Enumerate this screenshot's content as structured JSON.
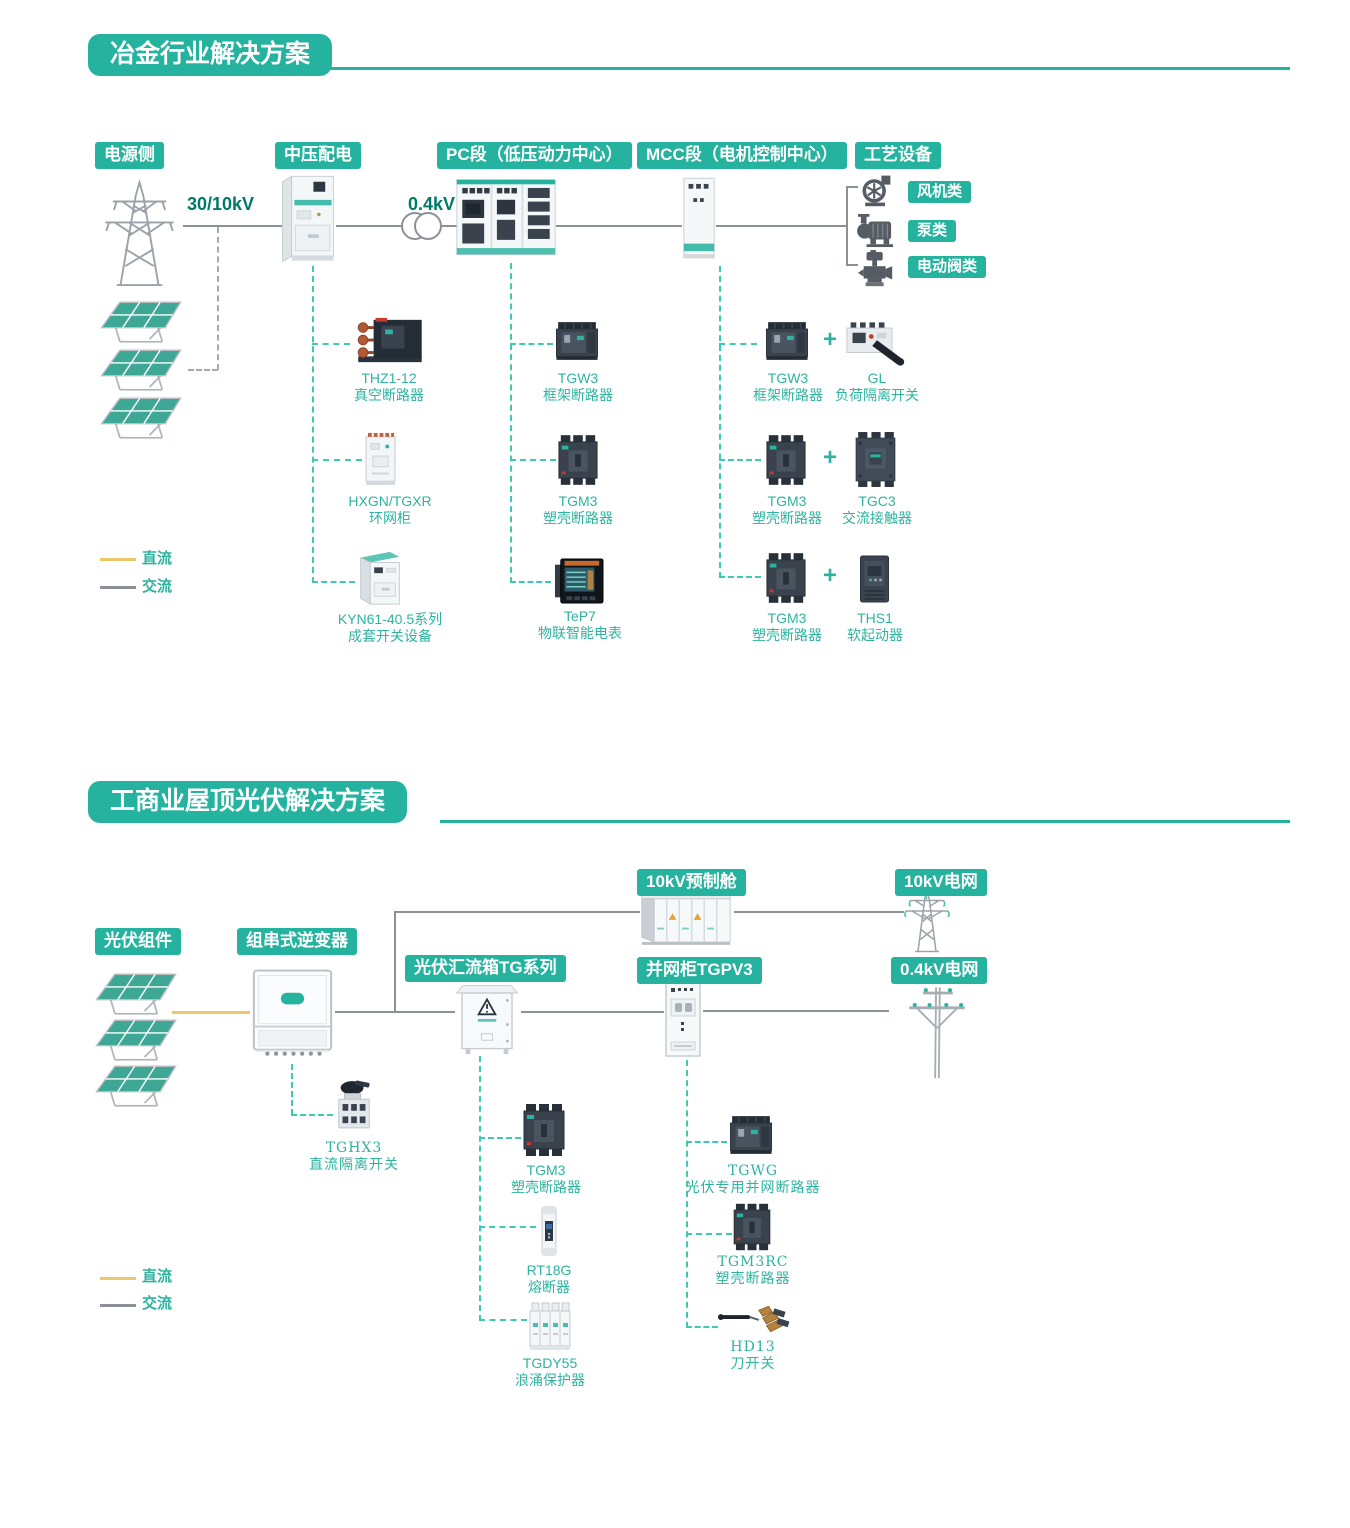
{
  "section1": {
    "title": "冶金行业解决方案",
    "stages": {
      "power": "电源侧",
      "mv": "中压配电",
      "pc": "PC段（低压动力中心）",
      "mcc": "MCC段（电机控制中心）",
      "process": "工艺设备"
    },
    "voltages": {
      "grid": "30/10kV",
      "lv": "0.4kV"
    },
    "equipment": {
      "fan": "风机类",
      "pump": "泵类",
      "valve": "电动阀类"
    },
    "mv_products": [
      {
        "model": "THZ1-12",
        "desc": "真空断路器"
      },
      {
        "model": "HXGN/TGXR",
        "desc": "环网柜"
      },
      {
        "model": "KYN61-40.5系列",
        "desc": "成套开关设备"
      }
    ],
    "pc_products": [
      {
        "model": "TGW3",
        "desc": "框架断路器"
      },
      {
        "model": "TGM3",
        "desc": "塑壳断路器"
      },
      {
        "model": "TeP7",
        "desc": "物联智能电表"
      }
    ],
    "mcc_pairs": [
      {
        "left": {
          "model": "TGW3",
          "desc": "框架断路器"
        },
        "plus": "+",
        "right": {
          "model": "GL",
          "desc": "负荷隔离开关"
        }
      },
      {
        "left": {
          "model": "TGM3",
          "desc": "塑壳断路器"
        },
        "plus": "+",
        "right": {
          "model": "TGC3",
          "desc": "交流接触器"
        }
      },
      {
        "left": {
          "model": "TGM3",
          "desc": "塑壳断路器"
        },
        "plus": "+",
        "right": {
          "model": "THS1",
          "desc": "软起动器"
        }
      }
    ],
    "legend": {
      "dc": "直流",
      "ac": "交流"
    }
  },
  "section2": {
    "title": "工商业屋顶光伏解决方案",
    "stages": {
      "pv": "光伏组件",
      "inverter": "组串式逆变器",
      "combiner": "光伏汇流箱TG系列",
      "grid_cabinet": "并网柜TGPV3",
      "cabin": "10kV预制舱",
      "grid10": "10kV电网",
      "grid04": "0.4kV电网"
    },
    "inverter_products": [
      {
        "model": "TGHX3",
        "desc": "直流隔离开关"
      }
    ],
    "combiner_products": [
      {
        "model": "TGM3",
        "desc": "塑壳断路器"
      },
      {
        "model": "RT18G",
        "desc": "熔断器"
      },
      {
        "model": "TGDY55",
        "desc": "浪涌保护器"
      }
    ],
    "cabinet_products": [
      {
        "model": "TGWG",
        "desc": "光伏专用并网断路器"
      },
      {
        "model": "TGM3RC",
        "desc": "塑壳断路器"
      },
      {
        "model": "HD13",
        "desc": "刀开关"
      }
    ],
    "legend": {
      "dc": "直流",
      "ac": "交流"
    }
  }
}
